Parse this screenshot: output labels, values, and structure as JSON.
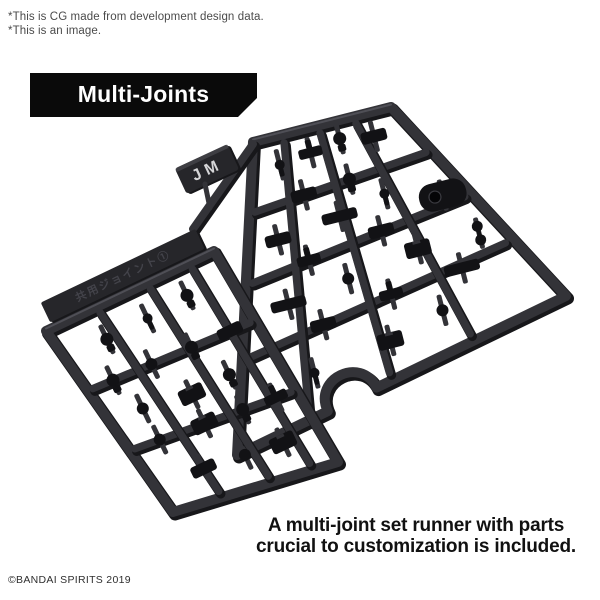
{
  "note": {
    "line1": "*This is CG made from development design data.",
    "line2": "*This is an image."
  },
  "banner": {
    "label": "Multi-Joints",
    "bg": "#0a0a0a",
    "text_color": "#ffffff"
  },
  "caption": {
    "line1": "A multi-joint set runner with parts",
    "line2": "crucial to customization is included."
  },
  "copyright": "©BANDAI SPIRITS 2019",
  "figure": {
    "tag_label": "JM",
    "left_runner_emboss": "共用ジョイント①",
    "colors": {
      "rail": "#333338",
      "rail_shadow": "#17171a",
      "rail_highlight": "#55555c",
      "part": "#121215",
      "part_hole": "#050507",
      "tag_bg": "#26262a",
      "tag_text": "#d6d6d8",
      "strip_bg": "#26262a",
      "emboss_text": "#43434a"
    },
    "tag": {
      "cx": 207,
      "cy": 169,
      "w": 58,
      "h": 28,
      "angle": -25
    },
    "right_runner": {
      "quad": [
        [
          253,
          142
        ],
        [
          391,
          107
        ],
        [
          566,
          296
        ],
        [
          237,
          455
        ]
      ],
      "h_bars": [
        0.23,
        0.46,
        0.7
      ],
      "v_bars": [
        0.22,
        0.47,
        0.72
      ],
      "notch": {
        "t": 0.65,
        "r": 27
      },
      "extra_rails": [
        [
          [
            253,
            144
          ],
          [
            193,
            229
          ]
        ]
      ],
      "parts": [
        [
          0.18,
          0.1,
          "peg"
        ],
        [
          0.38,
          0.09,
          "tblock"
        ],
        [
          0.58,
          0.07,
          "ballpeg"
        ],
        [
          0.78,
          0.1,
          "block"
        ],
        [
          0.3,
          0.23,
          "block"
        ],
        [
          0.55,
          0.23,
          "ballpeg"
        ],
        [
          0.9,
          0.42,
          "pill"
        ],
        [
          0.15,
          0.35,
          "block"
        ],
        [
          0.45,
          0.35,
          "barblock"
        ],
        [
          0.68,
          0.33,
          "peg"
        ],
        [
          0.28,
          0.46,
          "tblock"
        ],
        [
          0.6,
          0.46,
          "block"
        ],
        [
          0.92,
          0.62,
          "doubleball"
        ],
        [
          0.18,
          0.58,
          "barblock"
        ],
        [
          0.42,
          0.58,
          "ball"
        ],
        [
          0.7,
          0.58,
          "hblock"
        ],
        [
          0.3,
          0.7,
          "block"
        ],
        [
          0.55,
          0.7,
          "tblock"
        ],
        [
          0.8,
          0.72,
          "barblock"
        ],
        [
          0.25,
          0.85,
          "peg"
        ],
        [
          0.5,
          0.86,
          "hblock"
        ],
        [
          0.68,
          0.84,
          "ball"
        ]
      ]
    },
    "left_runner": {
      "quad": [
        [
          46,
          331
        ],
        [
          214,
          251
        ],
        [
          338,
          462
        ],
        [
          173,
          512
        ]
      ],
      "h_bars": [
        0.33,
        0.66
      ],
      "v_bars": [
        0.3,
        0.6,
        0.85
      ],
      "parts": [
        [
          0.25,
          0.15,
          "ballpeg"
        ],
        [
          0.5,
          0.14,
          "peg"
        ],
        [
          0.75,
          0.12,
          "ballpeg"
        ],
        [
          0.15,
          0.33,
          "ballpeg"
        ],
        [
          0.38,
          0.33,
          "ball"
        ],
        [
          0.62,
          0.33,
          "ballpeg"
        ],
        [
          0.85,
          0.33,
          "block"
        ],
        [
          0.2,
          0.5,
          "ball"
        ],
        [
          0.48,
          0.52,
          "hblock"
        ],
        [
          0.72,
          0.5,
          "ballpeg"
        ],
        [
          0.18,
          0.66,
          "ball"
        ],
        [
          0.45,
          0.66,
          "hblock"
        ],
        [
          0.68,
          0.66,
          "ballpeg"
        ],
        [
          0.88,
          0.66,
          "tblock"
        ],
        [
          0.3,
          0.85,
          "block"
        ],
        [
          0.55,
          0.85,
          "ball"
        ],
        [
          0.78,
          0.85,
          "hblock"
        ]
      ]
    }
  }
}
